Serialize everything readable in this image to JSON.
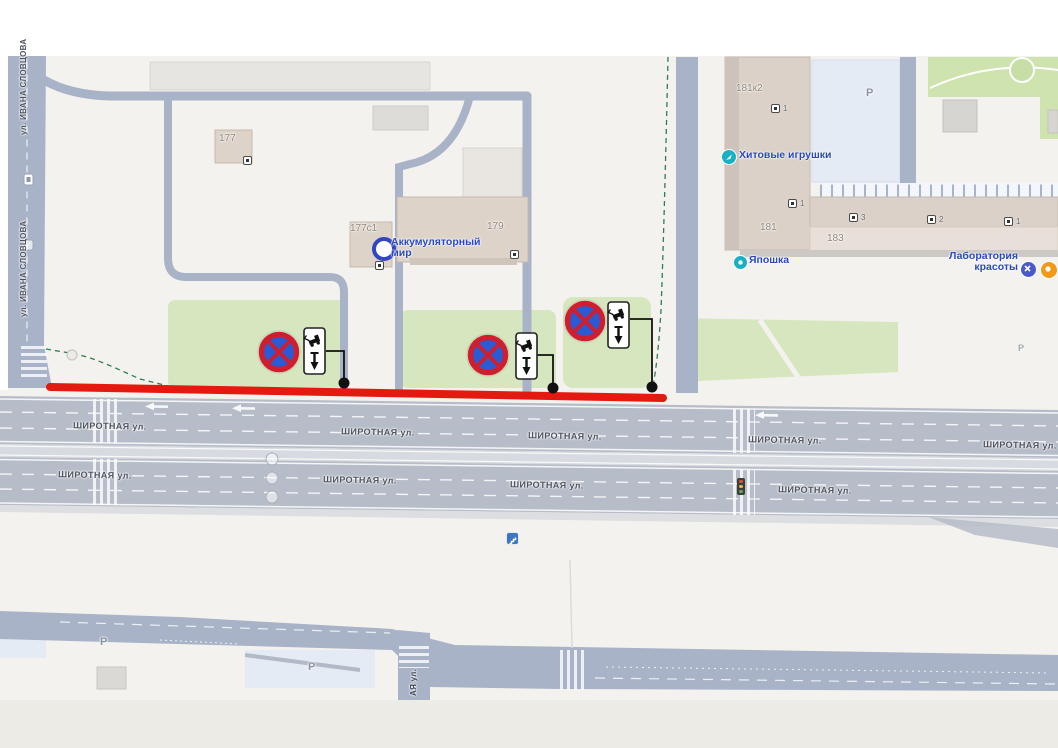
{
  "streets": {
    "shirotnaya": "ШИРОТНАЯ ул.",
    "ivana_slovtsova": "ул. ИВАНА СЛОВЦОВА",
    "cross_partial": "АЯ ул."
  },
  "buildings": {
    "b177": "177",
    "b177s1": "177с1",
    "b179": "179",
    "b181k2": "181к2",
    "b181": "181",
    "b183": "183"
  },
  "labels": {
    "parking": "Р"
  },
  "entrances": {
    "n1": "1",
    "n2": "2",
    "n3": "3"
  },
  "pois": {
    "toys": "Хитовые игрушки",
    "battery_l1": "Аккумуляторный",
    "battery_l2": "мир",
    "yaposhka": "Япошка",
    "lab_l1": "Лаборатория",
    "lab_l2": "красоты"
  },
  "icons": {
    "no_stopping_sign": "⊘ red-ring blue-fill red-X",
    "tow_away_plate": "tow-truck + down-arrow plate",
    "poi_teal_dot": "●",
    "battery_ring": "◎",
    "traffic_light": "▮",
    "underpass": "▣",
    "beauty_badge": "✕",
    "orange_badge": "●"
  },
  "colors": {
    "highlight_red": "#e41910",
    "sign_ring_red": "#cf1f2e",
    "sign_blue": "#2a5bd7",
    "lawn_green": "#d6e7bf",
    "road_major": "#b6bcc8",
    "road_minor": "#a9b3c8",
    "poi_text_blue": "#2847c0",
    "boundary_green": "#2f7d4e",
    "parking_lot_blue": "#e4ebf5"
  }
}
